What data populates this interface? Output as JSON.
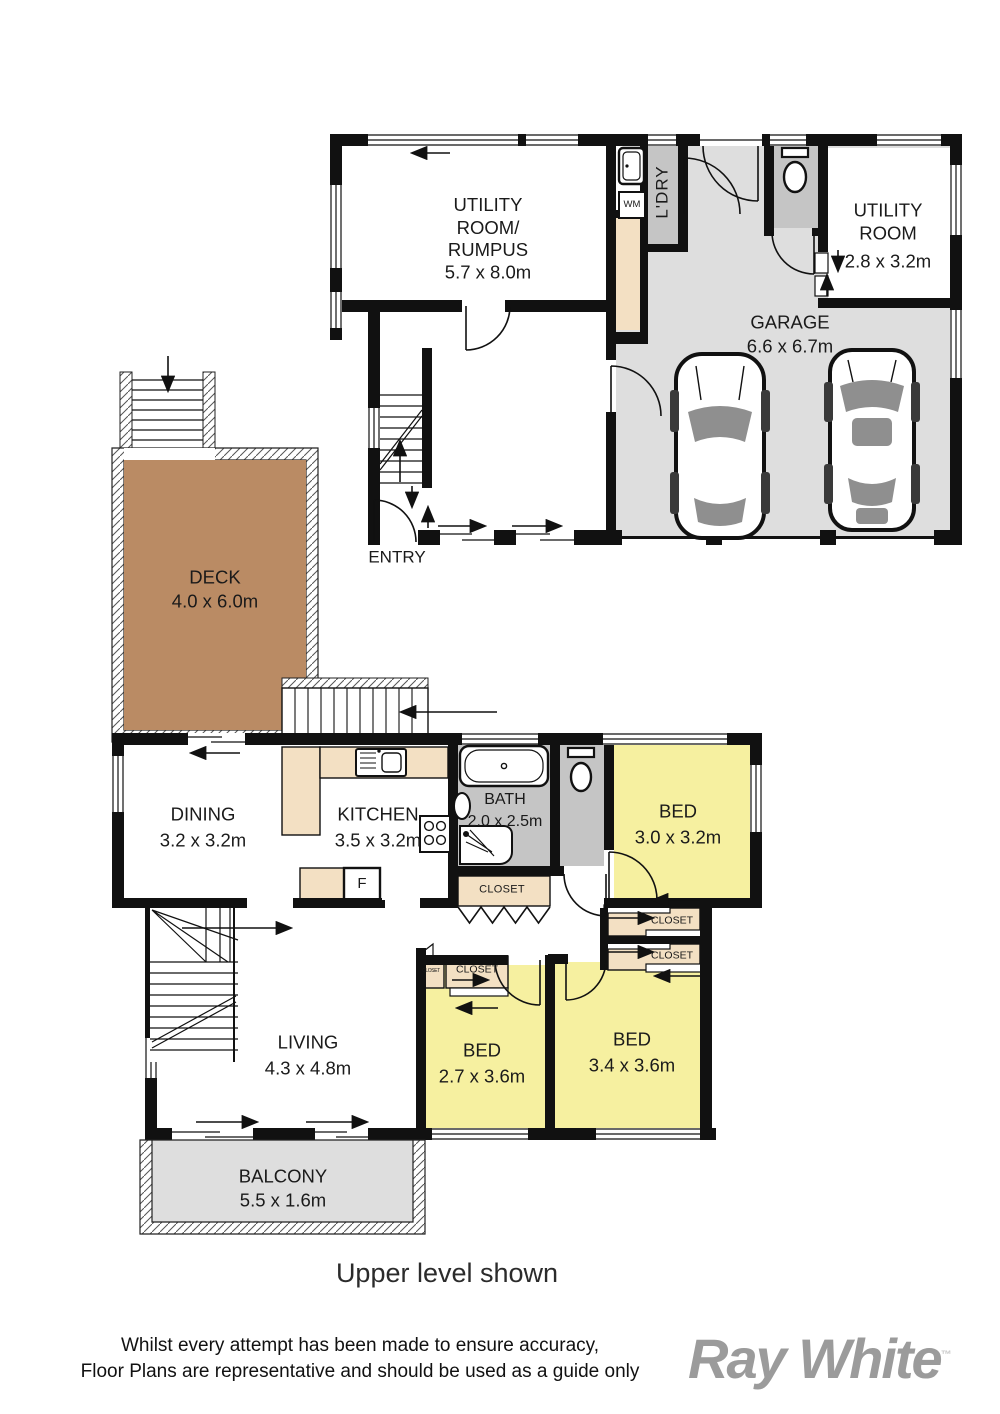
{
  "colors": {
    "wall": "#111111",
    "floor_gray": "#dedede",
    "room_gray": "#c5c5c5",
    "deck_brown": "#ba8b64",
    "bed_yellow": "#f6f0a0",
    "closet_tan": "#f3e0c3",
    "logo_gray": "#9b9b9b"
  },
  "upper_level": {
    "rooms": {
      "utility_rumpus": {
        "name": "UTILITY\nROOM/\nRUMPUS",
        "dims": "5.7 x 8.0m"
      },
      "laundry": {
        "name": "L'DRY"
      },
      "washing_machine": {
        "label": "WM"
      },
      "utility": {
        "name": "UTILITY\nROOM",
        "dims": "2.8 x 3.2m"
      },
      "garage": {
        "name": "GARAGE",
        "dims": "6.6 x 6.7m"
      },
      "entry": {
        "name": "ENTRY"
      }
    }
  },
  "lower_level": {
    "rooms": {
      "deck": {
        "name": "DECK",
        "dims": "4.0 x 6.0m"
      },
      "dining": {
        "name": "DINING",
        "dims": "3.2 x 3.2m"
      },
      "kitchen": {
        "name": "KITCHEN",
        "dims": "3.5 x 3.2m"
      },
      "fridge": {
        "label": "F"
      },
      "bath": {
        "name": "BATH",
        "dims": "2.0 x 2.5m"
      },
      "bed1": {
        "name": "BED",
        "dims": "3.0 x 3.2m"
      },
      "bed2": {
        "name": "BED",
        "dims": "2.7 x 3.6m"
      },
      "bed3": {
        "name": "BED",
        "dims": "3.4 x 3.6m"
      },
      "living": {
        "name": "LIVING",
        "dims": "4.3 x 4.8m"
      },
      "balcony": {
        "name": "BALCONY",
        "dims": "5.5 x 1.6m"
      },
      "closet_bath": {
        "label": "CLOSET"
      },
      "closet_hall_top": {
        "label": "CLOSET"
      },
      "closet_hall_bottom": {
        "label": "CLOSET"
      },
      "closet_bed2": {
        "label": "CLOSET"
      },
      "closet_bed2_small": {
        "label": "CLOSET"
      }
    }
  },
  "footer": {
    "caption": "Upper level shown",
    "disclaimer_line1": "Whilst every attempt has been made to ensure accuracy,",
    "disclaimer_line2": "Floor Plans are representative and should be used as a guide only",
    "brand": "Ray White",
    "brand_tm": "™"
  }
}
